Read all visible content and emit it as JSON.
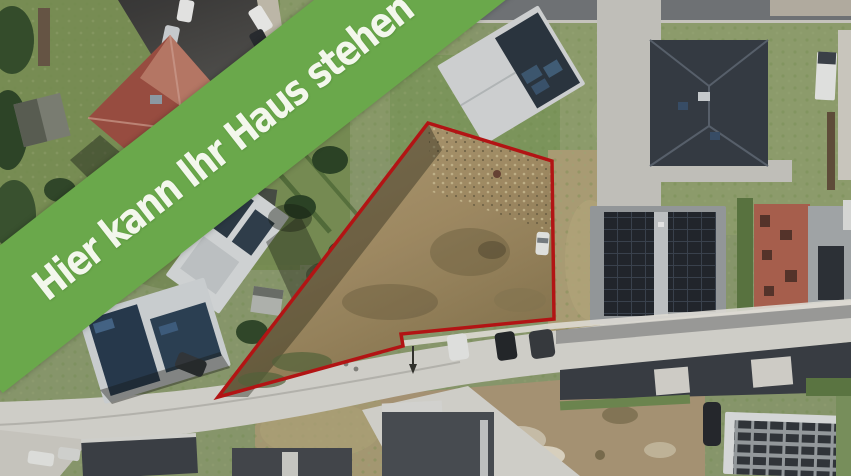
{
  "banner": {
    "text": "Hier kann Ihr Haus stehen",
    "background_color": "#6aa84b",
    "text_color": "#f3f7ec"
  },
  "plot_marker": {
    "outline_color": "#c01414",
    "dirt_fill_top": "#b7a277",
    "dirt_fill_bottom": "#8b784f"
  },
  "palette": {
    "grass": "#8d9c6d",
    "street_light": "#d9d7d1",
    "street_dark": "#4a4a47",
    "roof_dark": "#363d45",
    "roof_red": "#a14f42",
    "solar_panel": "#22262d"
  }
}
